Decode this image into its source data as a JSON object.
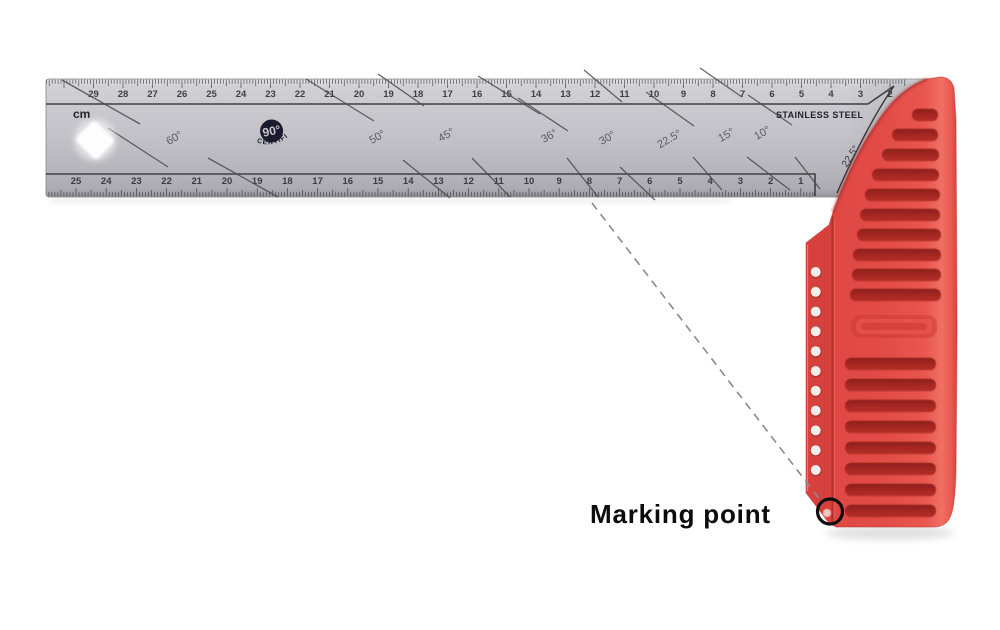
{
  "blade": {
    "unit_label": "cm",
    "material_label": "STAINLESS STEEL",
    "logo": {
      "degrees": "90°",
      "certified": "CERTIFIED"
    },
    "corner_angle_label": "22.5°",
    "top_scale": {
      "numbers": [
        29,
        28,
        27,
        26,
        25,
        24,
        23,
        22,
        21,
        20,
        19,
        18,
        17,
        16,
        15,
        14,
        13,
        12,
        11,
        10,
        9,
        8,
        7,
        6,
        5,
        4,
        3,
        2
      ]
    },
    "bottom_scale": {
      "numbers": [
        25,
        24,
        23,
        22,
        21,
        20,
        19,
        18,
        17,
        16,
        15,
        14,
        13,
        12,
        11,
        10,
        9,
        8,
        7,
        6,
        5,
        4,
        3,
        2,
        1
      ]
    },
    "angle_labels": [
      "60°",
      "50°",
      "45°",
      "36°",
      "30°",
      "22.5°",
      "15°",
      "10°"
    ]
  },
  "annotation": {
    "label": "Marking point"
  },
  "colors": {
    "handle_red": "#e24b46",
    "handle_slot_red": "#a32522",
    "blade_silver": "#c2c1c7",
    "ink": "#0d0d0d",
    "leader_gray": "#8a8a8a"
  }
}
